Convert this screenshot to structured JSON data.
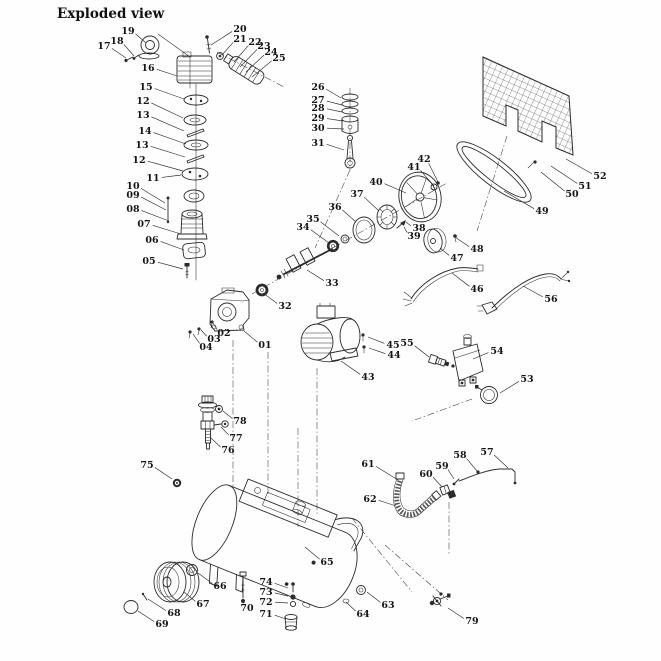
{
  "title": "Exploded view",
  "colors": {
    "line": "#2b2b2b",
    "background": "#fefefe",
    "label_text": "#151515"
  },
  "diagram": {
    "description_visible_text_only": true,
    "labels": [
      {
        "text": "19",
        "x": 128,
        "y": 31,
        "lx": 146,
        "ly": 43
      },
      {
        "text": "18",
        "x": 117,
        "y": 41,
        "lx": 134,
        "ly": 56
      },
      {
        "text": "17",
        "x": 104,
        "y": 46,
        "lx": 126,
        "ly": 58
      },
      {
        "text": "16",
        "x": 148,
        "y": 68,
        "lx": 177,
        "ly": 76
      },
      {
        "text": "15",
        "x": 146,
        "y": 87,
        "lx": 184,
        "ly": 99
      },
      {
        "text": "12",
        "x": 143,
        "y": 101,
        "lx": 183,
        "ly": 118
      },
      {
        "text": "13",
        "x": 143,
        "y": 115,
        "lx": 184,
        "ly": 131
      },
      {
        "text": "14",
        "x": 145,
        "y": 131,
        "lx": 186,
        "ly": 144
      },
      {
        "text": "13",
        "x": 142,
        "y": 145,
        "lx": 185,
        "ly": 157
      },
      {
        "text": "12",
        "x": 139,
        "y": 160,
        "lx": 183,
        "ly": 171
      },
      {
        "text": "11",
        "x": 153,
        "y": 178,
        "lx": 181,
        "ly": 175
      },
      {
        "text": "10",
        "x": 133,
        "y": 186,
        "lx": 165,
        "ly": 203
      },
      {
        "text": "09",
        "x": 133,
        "y": 195,
        "lx": 166,
        "ly": 210
      },
      {
        "text": "08",
        "x": 133,
        "y": 209,
        "lx": 169,
        "ly": 221
      },
      {
        "text": "07",
        "x": 144,
        "y": 224,
        "lx": 181,
        "ly": 234
      },
      {
        "text": "06",
        "x": 152,
        "y": 240,
        "lx": 184,
        "ly": 250
      },
      {
        "text": "05",
        "x": 149,
        "y": 261,
        "lx": 183,
        "ly": 269
      },
      {
        "text": "20",
        "x": 240,
        "y": 29,
        "lx": 211,
        "ly": 45
      },
      {
        "text": "21",
        "x": 240,
        "y": 39,
        "lx": 222,
        "ly": 55
      },
      {
        "text": "22",
        "x": 255,
        "y": 42,
        "lx": 234,
        "ly": 62
      },
      {
        "text": "23",
        "x": 264,
        "y": 46,
        "lx": 240,
        "ly": 67
      },
      {
        "text": "24",
        "x": 271,
        "y": 52,
        "lx": 246,
        "ly": 72
      },
      {
        "text": "25",
        "x": 279,
        "y": 58,
        "lx": 252,
        "ly": 77
      },
      {
        "text": "26",
        "x": 318,
        "y": 87,
        "lx": 341,
        "ly": 98
      },
      {
        "text": "27",
        "x": 318,
        "y": 100,
        "lx": 342,
        "ly": 105
      },
      {
        "text": "28",
        "x": 318,
        "y": 108,
        "lx": 342,
        "ly": 112
      },
      {
        "text": "29",
        "x": 318,
        "y": 118,
        "lx": 343,
        "ly": 121
      },
      {
        "text": "30",
        "x": 318,
        "y": 128,
        "lx": 344,
        "ly": 129
      },
      {
        "text": "31",
        "x": 318,
        "y": 143,
        "lx": 344,
        "ly": 150
      },
      {
        "text": "42",
        "x": 424,
        "y": 159,
        "lx": 438,
        "ly": 182
      },
      {
        "text": "41",
        "x": 414,
        "y": 167,
        "lx": 434,
        "ly": 186
      },
      {
        "text": "40",
        "x": 376,
        "y": 182,
        "lx": 406,
        "ly": 193
      },
      {
        "text": "37",
        "x": 357,
        "y": 194,
        "lx": 379,
        "ly": 211
      },
      {
        "text": "36",
        "x": 335,
        "y": 207,
        "lx": 356,
        "ly": 222
      },
      {
        "text": "35",
        "x": 313,
        "y": 219,
        "lx": 339,
        "ly": 236
      },
      {
        "text": "34",
        "x": 303,
        "y": 227,
        "lx": 329,
        "ly": 243
      },
      {
        "text": "38",
        "x": 419,
        "y": 228,
        "lx": 406,
        "ly": 222
      },
      {
        "text": "39",
        "x": 414,
        "y": 236,
        "lx": 404,
        "ly": 227
      },
      {
        "text": "47",
        "x": 457,
        "y": 258,
        "lx": 440,
        "ly": 248
      },
      {
        "text": "48",
        "x": 477,
        "y": 249,
        "lx": 455,
        "ly": 237
      },
      {
        "text": "49",
        "x": 542,
        "y": 211,
        "lx": 504,
        "ly": 191
      },
      {
        "text": "50",
        "x": 572,
        "y": 194,
        "lx": 541,
        "ly": 172
      },
      {
        "text": "51",
        "x": 585,
        "y": 186,
        "lx": 551,
        "ly": 166
      },
      {
        "text": "52",
        "x": 600,
        "y": 176,
        "lx": 566,
        "ly": 159
      },
      {
        "text": "33",
        "x": 332,
        "y": 283,
        "lx": 307,
        "ly": 270
      },
      {
        "text": "32",
        "x": 285,
        "y": 306,
        "lx": 263,
        "ly": 293
      },
      {
        "text": "01",
        "x": 265,
        "y": 345,
        "lx": 244,
        "ly": 331
      },
      {
        "text": "02",
        "x": 224,
        "y": 333,
        "lx": 213,
        "ly": 323
      },
      {
        "text": "03",
        "x": 214,
        "y": 339,
        "lx": 201,
        "ly": 330
      },
      {
        "text": "04",
        "x": 206,
        "y": 347,
        "lx": 193,
        "ly": 334
      },
      {
        "text": "43",
        "x": 368,
        "y": 377,
        "lx": 341,
        "ly": 361
      },
      {
        "text": "45",
        "x": 393,
        "y": 345,
        "lx": 368,
        "ly": 337
      },
      {
        "text": "44",
        "x": 394,
        "y": 355,
        "lx": 369,
        "ly": 348
      },
      {
        "text": "55",
        "x": 407,
        "y": 343,
        "lx": 429,
        "ly": 357
      },
      {
        "text": "54",
        "x": 497,
        "y": 351,
        "lx": 473,
        "ly": 359
      },
      {
        "text": "53",
        "x": 527,
        "y": 379,
        "lx": 500,
        "ly": 393
      },
      {
        "text": "46",
        "x": 477,
        "y": 289,
        "lx": 452,
        "ly": 273
      },
      {
        "text": "56",
        "x": 551,
        "y": 299,
        "lx": 523,
        "ly": 286
      },
      {
        "text": "78",
        "x": 240,
        "y": 421,
        "lx": 223,
        "ly": 411
      },
      {
        "text": "77",
        "x": 236,
        "y": 438,
        "lx": 221,
        "ly": 427
      },
      {
        "text": "76",
        "x": 228,
        "y": 450,
        "lx": 211,
        "ly": 438
      },
      {
        "text": "75",
        "x": 147,
        "y": 465,
        "lx": 172,
        "ly": 479
      },
      {
        "text": "61",
        "x": 368,
        "y": 464,
        "lx": 398,
        "ly": 480
      },
      {
        "text": "62",
        "x": 370,
        "y": 499,
        "lx": 396,
        "ly": 506
      },
      {
        "text": "60",
        "x": 426,
        "y": 474,
        "lx": 442,
        "ly": 487
      },
      {
        "text": "59",
        "x": 442,
        "y": 466,
        "lx": 454,
        "ly": 479
      },
      {
        "text": "58",
        "x": 460,
        "y": 455,
        "lx": 477,
        "ly": 471
      },
      {
        "text": "57",
        "x": 487,
        "y": 452,
        "lx": 508,
        "ly": 468
      },
      {
        "text": "65",
        "x": 327,
        "y": 562,
        "lx": 305,
        "ly": 547
      },
      {
        "text": "66",
        "x": 220,
        "y": 586,
        "lx": 198,
        "ly": 573
      },
      {
        "text": "67",
        "x": 203,
        "y": 604,
        "lx": 184,
        "ly": 592
      },
      {
        "text": "68",
        "x": 174,
        "y": 613,
        "lx": 148,
        "ly": 599
      },
      {
        "text": "69",
        "x": 162,
        "y": 624,
        "lx": 138,
        "ly": 611
      },
      {
        "text": "70",
        "x": 247,
        "y": 608,
        "lx": 244,
        "ly": 601
      },
      {
        "text": "74",
        "x": 266,
        "y": 582,
        "lx": 288,
        "ly": 588
      },
      {
        "text": "73",
        "x": 266,
        "y": 592,
        "lx": 288,
        "ly": 596
      },
      {
        "text": "72",
        "x": 266,
        "y": 602,
        "lx": 288,
        "ly": 603
      },
      {
        "text": "71",
        "x": 266,
        "y": 614,
        "lx": 286,
        "ly": 619
      },
      {
        "text": "64",
        "x": 363,
        "y": 614,
        "lx": 346,
        "ly": 602
      },
      {
        "text": "63",
        "x": 388,
        "y": 605,
        "lx": 367,
        "ly": 592
      },
      {
        "text": "79",
        "x": 472,
        "y": 621,
        "lx": 448,
        "ly": 608
      }
    ]
  }
}
